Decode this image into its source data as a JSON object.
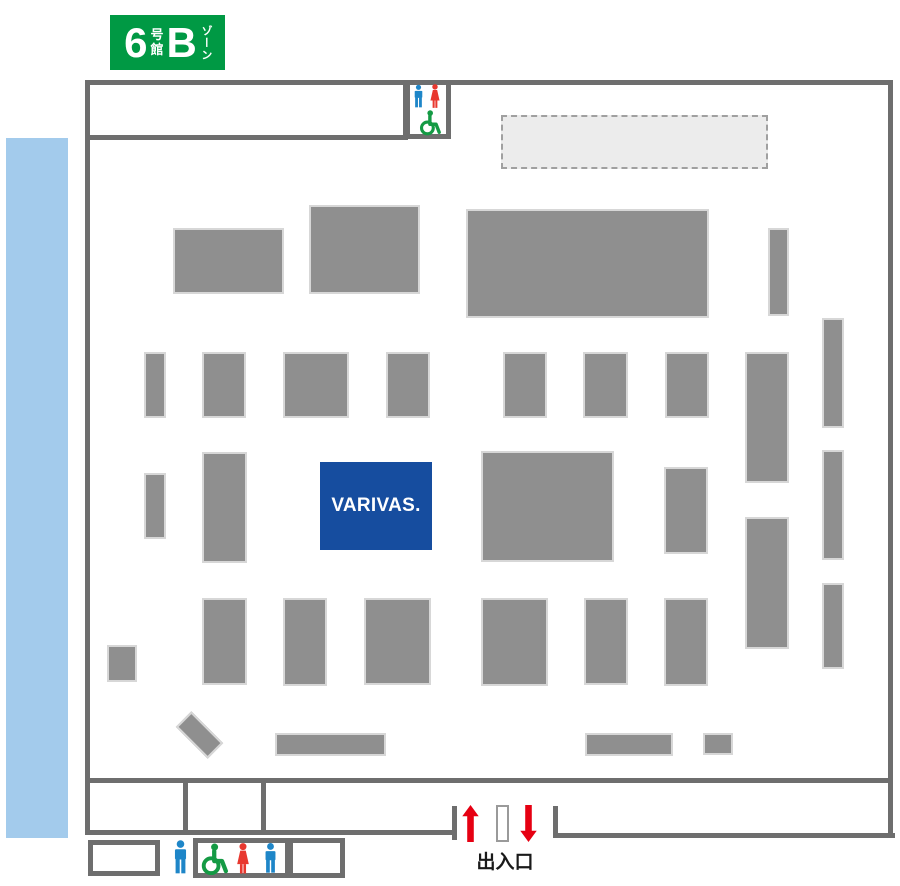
{
  "badge": {
    "hall_number": "6",
    "hall_suffix_top": "号",
    "hall_suffix_bottom": "館",
    "zone_letter": "B",
    "zone_suffix": "ゾーン",
    "color": "#009944"
  },
  "varivas": {
    "label": "VARIVAS.",
    "color": "#164d9f"
  },
  "entrance": {
    "label": "出入口",
    "arrow_color": "#e60012"
  },
  "colors": {
    "wall": "#6e6e6e",
    "booth": "#8f8f8f",
    "water_strip": "#a3cbec",
    "dashed_area_fill": "#ececec",
    "icon_man_blue": "#1e86c8",
    "icon_woman_red": "#e8382f",
    "icon_wheelchair_green": "#149a44"
  },
  "icons": {
    "top_restroom": [
      "man-icon",
      "woman-icon",
      "wheelchair-icon"
    ],
    "bottom_restroom": [
      "man-icon",
      "wheelchair-icon",
      "woman-icon",
      "man-icon"
    ],
    "entrance": [
      "arrow-up-icon",
      "arrow-down-icon"
    ]
  },
  "map": {
    "booths": [
      {
        "x": 173,
        "y": 228,
        "w": 111,
        "h": 66
      },
      {
        "x": 309,
        "y": 205,
        "w": 111,
        "h": 89
      },
      {
        "x": 466,
        "y": 209,
        "w": 243,
        "h": 109
      },
      {
        "x": 768,
        "y": 228,
        "w": 21,
        "h": 88
      },
      {
        "x": 144,
        "y": 352,
        "w": 22,
        "h": 66
      },
      {
        "x": 202,
        "y": 352,
        "w": 44,
        "h": 66
      },
      {
        "x": 283,
        "y": 352,
        "w": 66,
        "h": 66
      },
      {
        "x": 386,
        "y": 352,
        "w": 44,
        "h": 66
      },
      {
        "x": 503,
        "y": 352,
        "w": 44,
        "h": 66
      },
      {
        "x": 583,
        "y": 352,
        "w": 45,
        "h": 66
      },
      {
        "x": 665,
        "y": 352,
        "w": 44,
        "h": 66
      },
      {
        "x": 745,
        "y": 352,
        "w": 44,
        "h": 131
      },
      {
        "x": 822,
        "y": 318,
        "w": 22,
        "h": 110
      },
      {
        "x": 144,
        "y": 473,
        "w": 22,
        "h": 66
      },
      {
        "x": 202,
        "y": 452,
        "w": 45,
        "h": 111
      },
      {
        "x": 481,
        "y": 451,
        "w": 133,
        "h": 111
      },
      {
        "x": 664,
        "y": 467,
        "w": 44,
        "h": 87
      },
      {
        "x": 745,
        "y": 517,
        "w": 44,
        "h": 132
      },
      {
        "x": 822,
        "y": 450,
        "w": 22,
        "h": 110
      },
      {
        "x": 822,
        "y": 583,
        "w": 22,
        "h": 86
      },
      {
        "x": 107,
        "y": 645,
        "w": 30,
        "h": 37
      },
      {
        "x": 202,
        "y": 598,
        "w": 45,
        "h": 87
      },
      {
        "x": 283,
        "y": 598,
        "w": 44,
        "h": 88
      },
      {
        "x": 364,
        "y": 598,
        "w": 67,
        "h": 87
      },
      {
        "x": 481,
        "y": 598,
        "w": 67,
        "h": 88
      },
      {
        "x": 584,
        "y": 598,
        "w": 44,
        "h": 87
      },
      {
        "x": 664,
        "y": 598,
        "w": 44,
        "h": 88
      },
      {
        "x": 177,
        "y": 724,
        "w": 45,
        "h": 22,
        "rotate": 45
      },
      {
        "x": 275,
        "y": 733,
        "w": 111,
        "h": 23
      },
      {
        "x": 585,
        "y": 733,
        "w": 88,
        "h": 23
      },
      {
        "x": 703,
        "y": 733,
        "w": 30,
        "h": 22
      }
    ]
  }
}
